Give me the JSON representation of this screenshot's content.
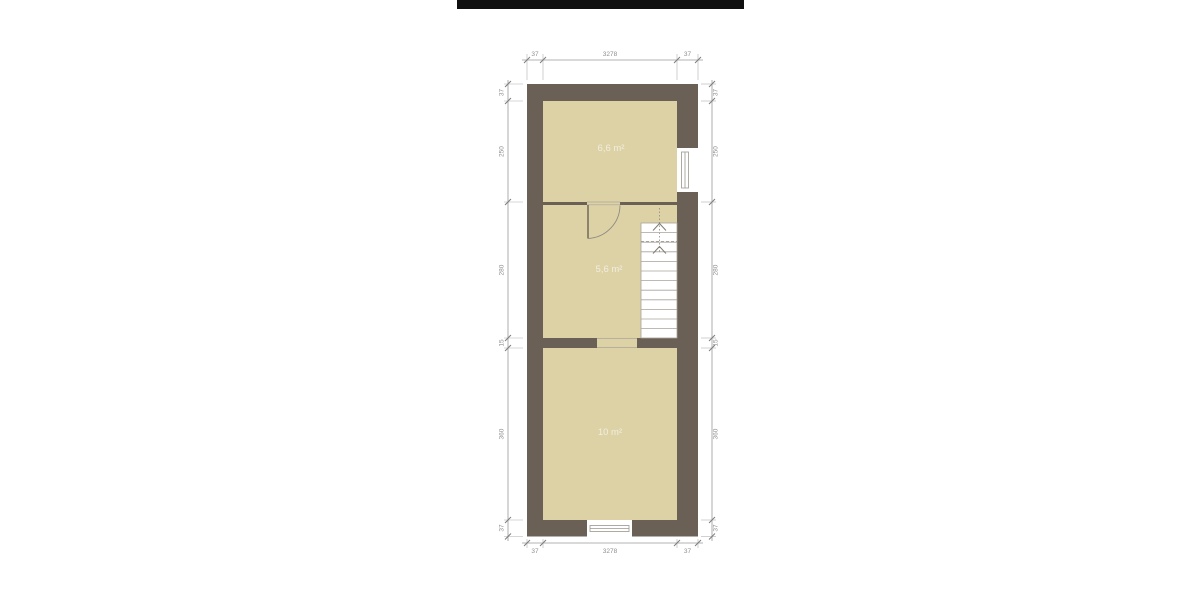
{
  "scale_bar": {
    "description": "solid black horizontal bar at top of drawing sheet"
  },
  "plan": {
    "rooms": [
      {
        "id": "room-top",
        "area_label": "6,6 m²"
      },
      {
        "id": "room-middle",
        "area_label": "5,6 m²"
      },
      {
        "id": "room-bottom",
        "area_label": "10 m²"
      }
    ],
    "features": [
      "staircase-up",
      "door-swing",
      "window-right-wall",
      "window-bottom-wall"
    ],
    "dimensions": {
      "top": [
        "37",
        "3278",
        "37"
      ],
      "bottom": [
        "37",
        "3278",
        "37"
      ],
      "left": [
        "37",
        "250",
        "280",
        "15",
        "360",
        "37"
      ],
      "right": [
        "37",
        "250",
        "280",
        "15",
        "360",
        "37"
      ]
    },
    "colors": {
      "wall": "#6b6055",
      "room_fill": "#ddd2a6",
      "stair_fill": "#ffffff",
      "dimension_lines": "#9a9a9a",
      "dimension_text": "#8f8f8f",
      "room_label": "#f2edde",
      "scale_bar": "#101010",
      "background": "#ffffff"
    }
  }
}
